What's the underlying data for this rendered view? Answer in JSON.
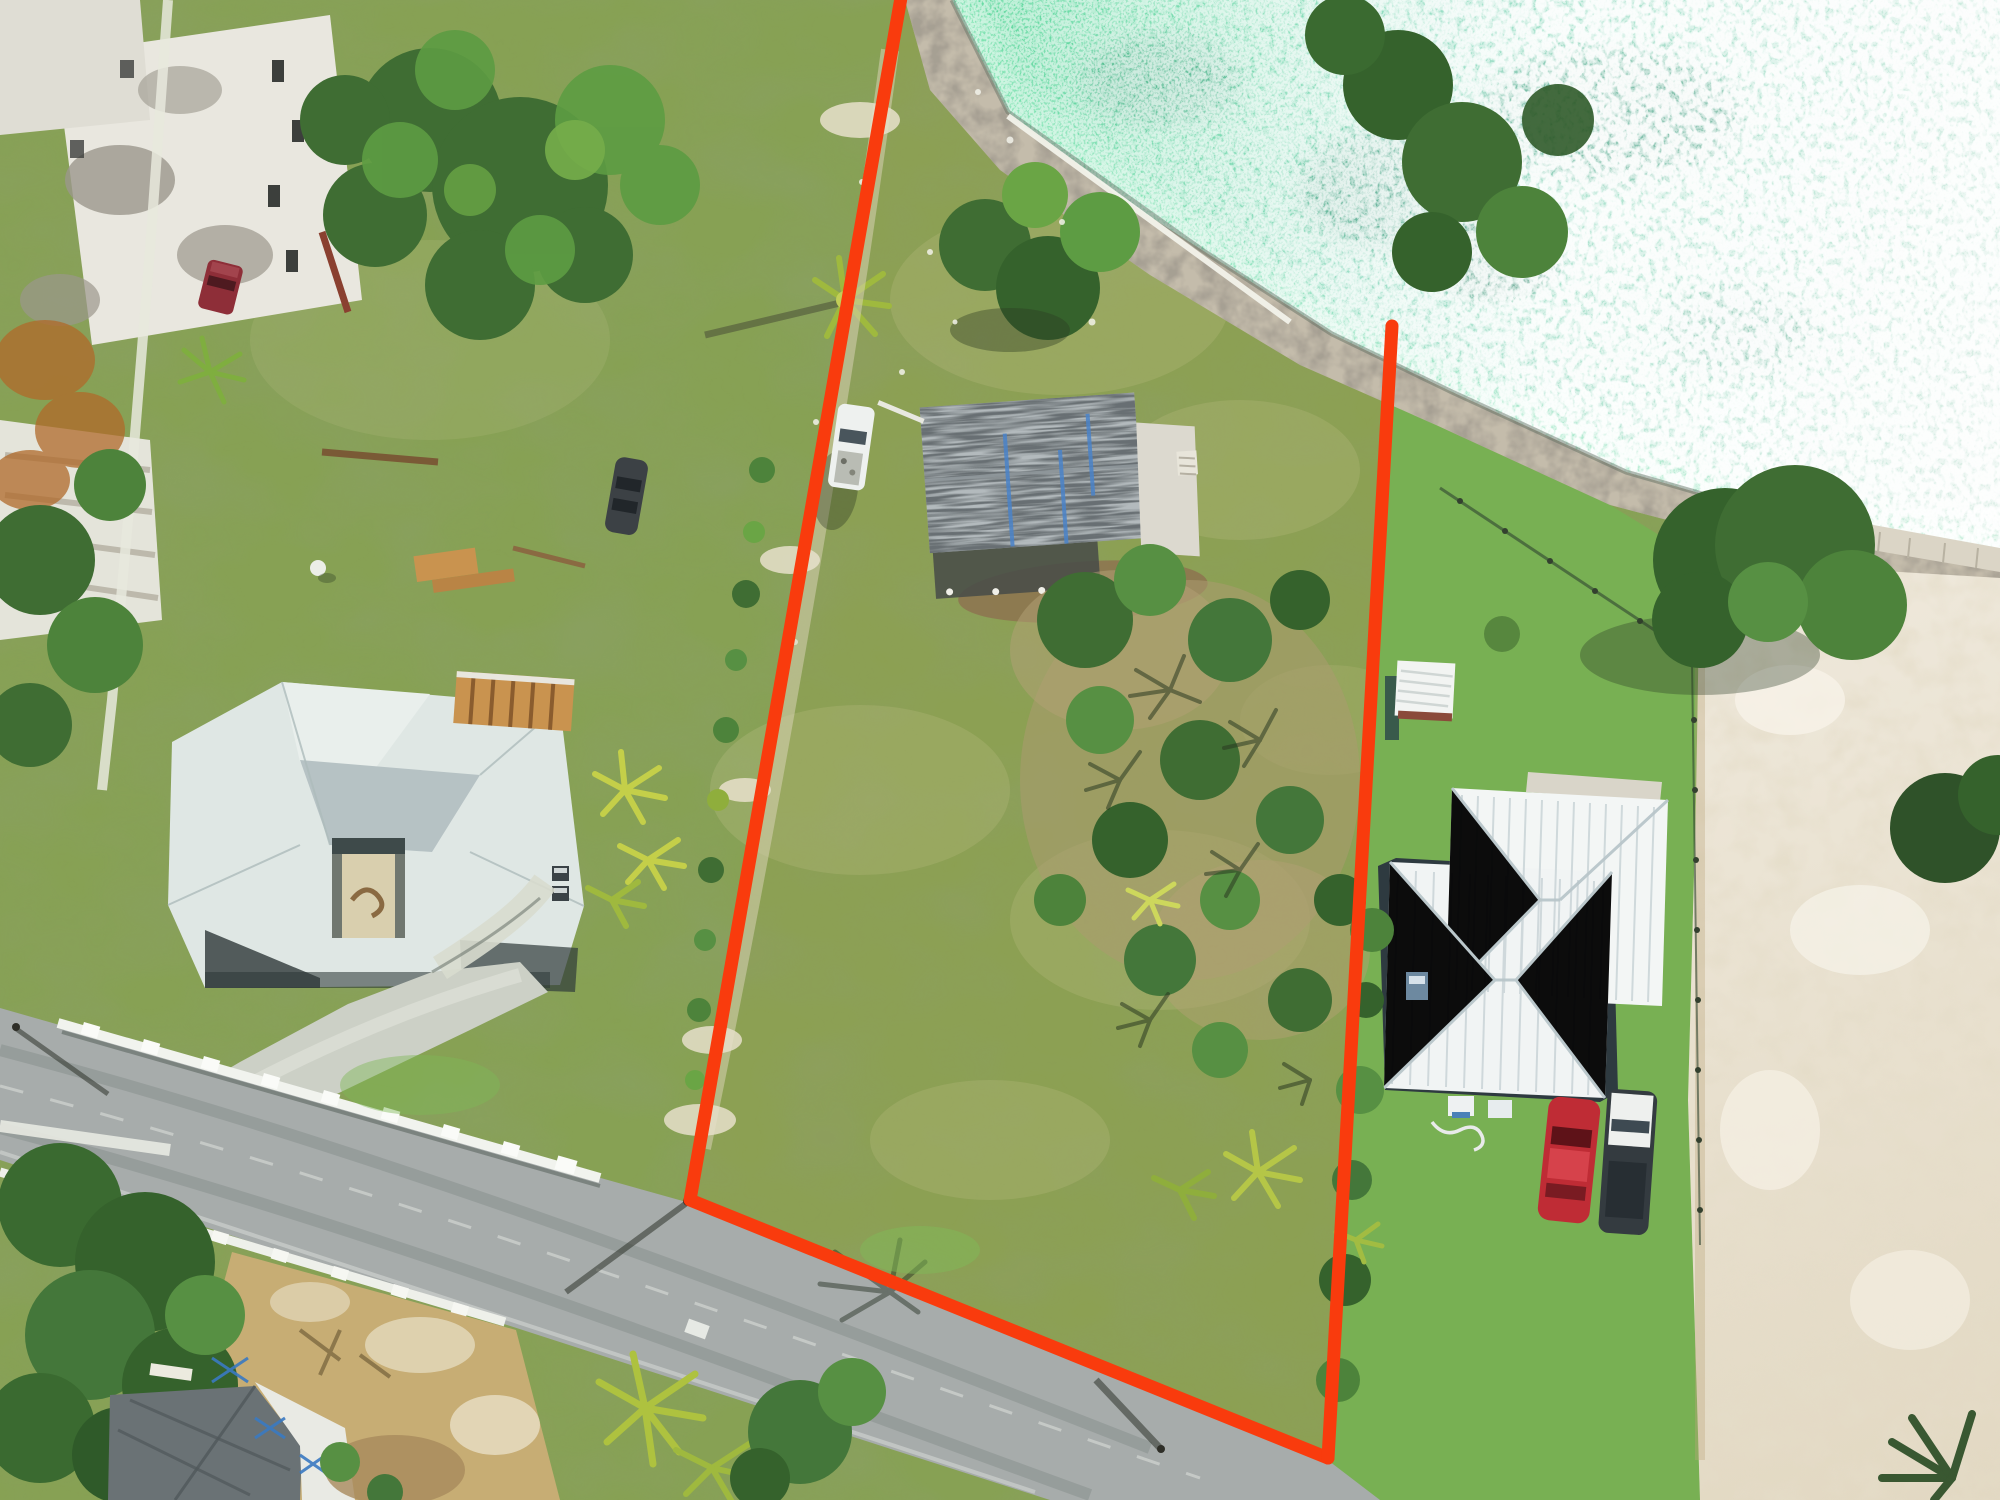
{
  "scene": {
    "kind": "aerial-drone-real-estate-photo",
    "description": "Top-down drone photo of a waterfront vacant lot outlined in red, flanked by two neighboring houses, a diagonal road at bottom left, turquoise sparkling sea at top right, rocky shoreline, ruined buildings top left and white sand at right.",
    "width_px": 2000,
    "height_px": 1500
  },
  "boundary": {
    "color": "#f93b0d",
    "stroke_width": 13,
    "left_line": [
      [
        902,
        0
      ],
      [
        690,
        1200
      ]
    ],
    "road_line": [
      [
        690,
        1200
      ],
      [
        1328,
        1458
      ]
    ],
    "right_line": [
      [
        1392,
        326
      ],
      [
        1328,
        1458
      ]
    ]
  },
  "colors": {
    "boundary_red": "#f93b0d",
    "water_near": "#5fd89e",
    "water_mid": "#9adec6",
    "water_far": "#dceee6",
    "water_deep_patch": "#2e7f68",
    "grass_base": "#87a154",
    "grass_dry": "#b9bd85",
    "lawn_green": "#78b053",
    "scrub_green": "#3f6d33",
    "bush_green": "#5d9c43",
    "palm_yellow": "#c9d355",
    "rock_tan": "#c4bcab",
    "sand_light": "#efe9dc",
    "sand_deep": "#e2d8c2",
    "road_gray": "#a7acab",
    "concrete": "#ccd0c6",
    "wall_white": "#f1f3ee",
    "left_roof": "#dfe7e4",
    "left_roof_dark": "#b6c2c4",
    "right_roof": "#f3f6f5",
    "damaged_roof": "#b3babd",
    "tarp_blue": "#4a83c9",
    "patio_white": "#dcd9cf",
    "mulch_brown": "#8d7350",
    "dirt_tan": "#ab9a70",
    "dry_field": "#c7ad74",
    "truck_white": "#eef1ef",
    "truck_maroon": "#8e2e38",
    "car_red": "#bf2c35",
    "suv_dark": "#343b40",
    "suv_white": "#eef0ee",
    "ruin_white": "#e9e7df",
    "wood_tan": "#c9934f",
    "seawall_white": "#f2f2ea",
    "courtyard_sand": "#d9cfae"
  },
  "objects": {
    "subject_lot": "vacant waterfront lot outlined in red",
    "damaged_building": "small structure with storm-damaged shingle roof and blue tarp strips",
    "white_pickup": "white pickup truck parked by damaged building",
    "dark_car": "dark car parked along west track",
    "left_house": "neighbor house with pale gray hip roof and center courtyard",
    "right_house": "neighbor house with white ribbed metal roof",
    "shed": "small white shed on right lot",
    "red_car": "red car parked at right house",
    "white_suv": "white and dark SUV parked at right house",
    "maroon_truck": "maroon truck near ruins",
    "ruins": "hurricane-damaged white buildings top left",
    "road": "asphalt road running diagonally across bottom left",
    "white_walls": "low white walls with post caps along road",
    "construction_house": "house under construction bottom left",
    "water": "turquoise sea with sun glitter",
    "shoreline": "rocky shoreline with white seawall",
    "sand_area": "white sand clearing on right edge"
  }
}
